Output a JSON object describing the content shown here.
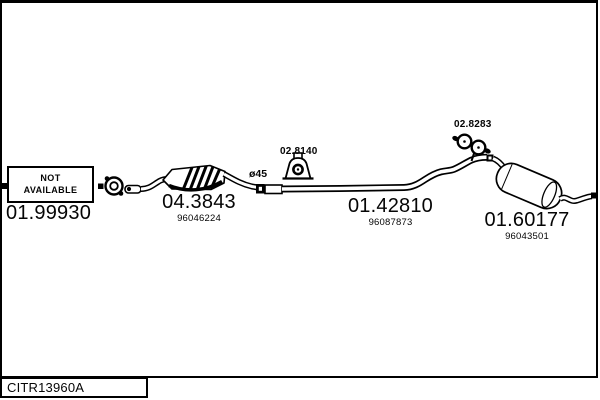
{
  "colors": {
    "ink": "#000000",
    "background": "#ffffff"
  },
  "drawing": {
    "not_available": {
      "line1": "NOT",
      "line2": "AVAILABLE"
    },
    "parts": {
      "front_pipe": {
        "code": "01.99930"
      },
      "catalytic_converter": {
        "code": "04.3843",
        "oe": "96046224"
      },
      "centre_pipe": {
        "code": "01.42810",
        "oe": "96087873"
      },
      "rear_silencer": {
        "code": "01.60177",
        "oe": "96043501"
      },
      "mid_hanger": {
        "code": "02.8140"
      },
      "rear_hanger": {
        "code": "02.8283"
      }
    },
    "pipe_diameter": "ø45"
  },
  "footer": {
    "reference": "CITR13960A"
  }
}
